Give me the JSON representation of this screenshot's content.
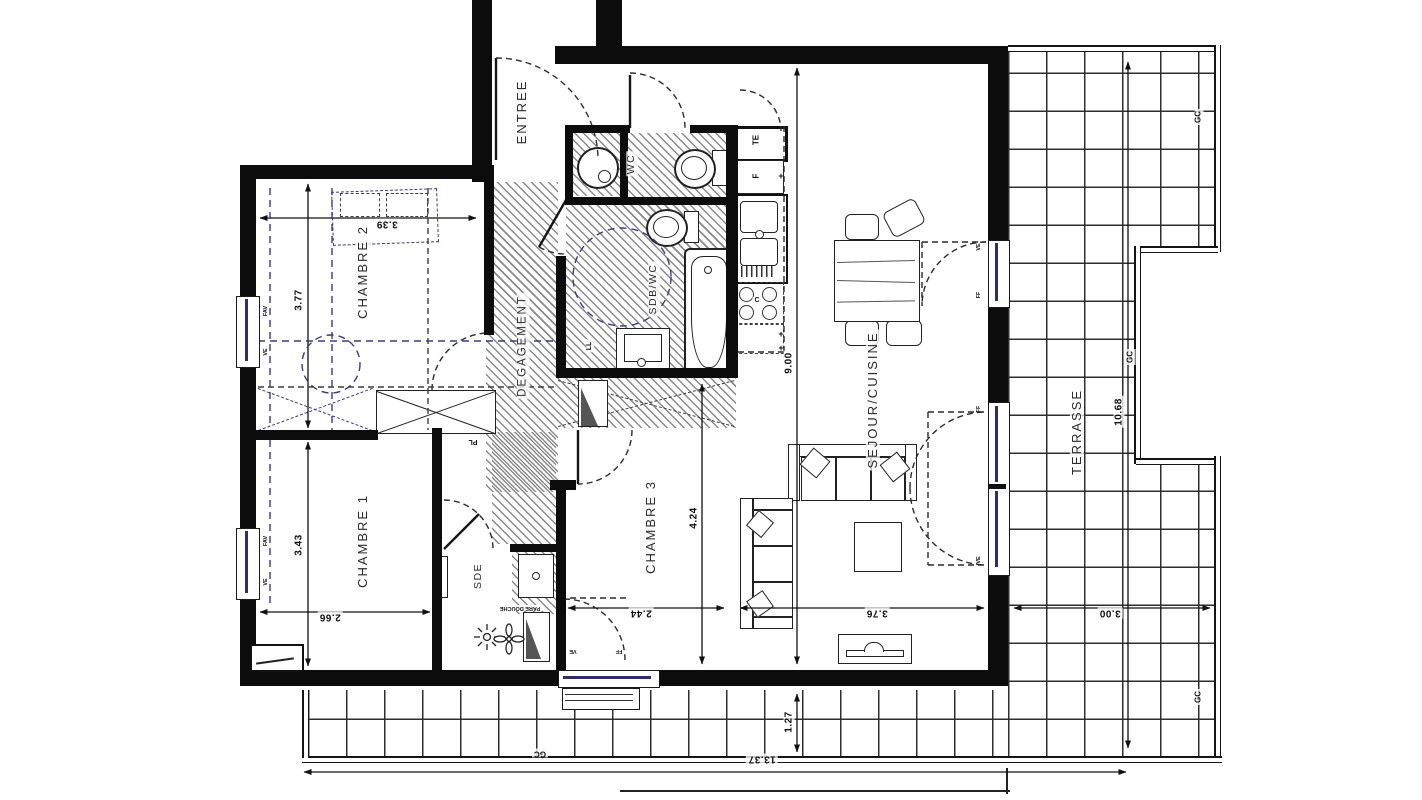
{
  "plan": {
    "rooms": {
      "entree": "ENTREE",
      "chambre2": "CHAMBRE 2",
      "chambre1": "CHAMBRE 1",
      "chambre3": "CHAMBRE 3",
      "degagement": "DEGAGEMENT",
      "wc": "WC",
      "sdb_wc": "SDB/WC",
      "sde": "SDE",
      "sejour_cuisine": "SEJOUR/CUISINE",
      "terrasse": "TERRASSE"
    },
    "dimensions": {
      "chambre2_width": "3.39",
      "chambre2_height": "3.77",
      "chambre1_height": "3.43",
      "chambre1_width": "2.66",
      "chambre3_height": "4.24",
      "chambre3_width": "2.44",
      "sejour_height": "9.00",
      "sejour_width": "3.76",
      "terrasse_height": "10.68",
      "terrasse_right_width": "3.00",
      "terrasse_front_depth": "1.27",
      "terrasse_total_width": "13.37"
    },
    "annotations": {
      "te": "TE",
      "f": "F",
      "c": "C",
      "ll": "LL",
      "pl": "PL",
      "gc": "GC",
      "ve": "VE",
      "ff": "FF",
      "fav": "FAV",
      "pare_douche": "PARE DOUCHE",
      "plus": "+"
    },
    "colors": {
      "wall": "#0c0c0c",
      "line": "#1a1a1a",
      "hatch": "#8a8a8a",
      "dashed_blue": "#3c3c78",
      "grid": "#2e2e2e"
    }
  }
}
